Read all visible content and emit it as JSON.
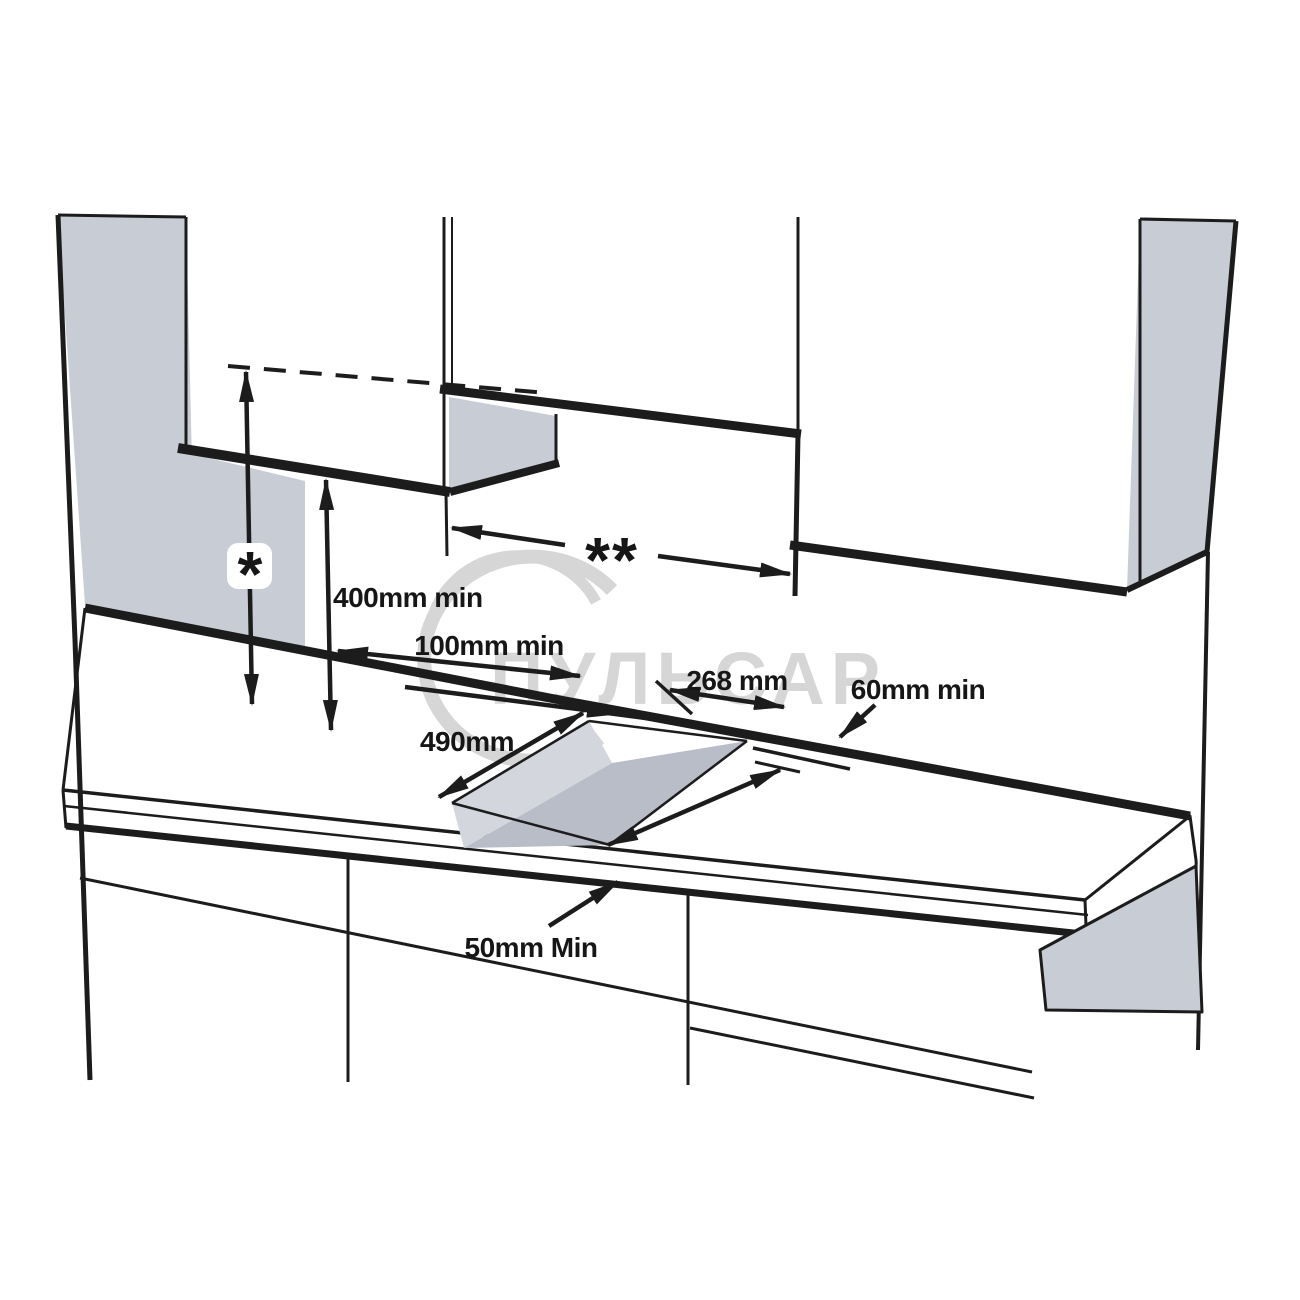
{
  "diagram": {
    "title": "hob-installation-clearance-diagram",
    "annotations": {
      "star": "*",
      "double_star": "**",
      "cabinet_height_min": "400mm min",
      "rear_clearance_min": "100mm min",
      "cutout_width": "268 mm",
      "side_clearance_min": "60mm min",
      "cutout_length": "490mm",
      "front_clearance_min": "50mm Min"
    },
    "watermark": {
      "text": "ПУЛЬСАР",
      "color": "#d4d4d4"
    },
    "colors": {
      "line": "#1c1c1c",
      "label": "#161616",
      "panel_gray": "#c8ccd4",
      "cutout_side_gray": "#d3d6dd",
      "cutout_inner_gray": "#b8bdc8",
      "background": "#ffffff"
    }
  }
}
